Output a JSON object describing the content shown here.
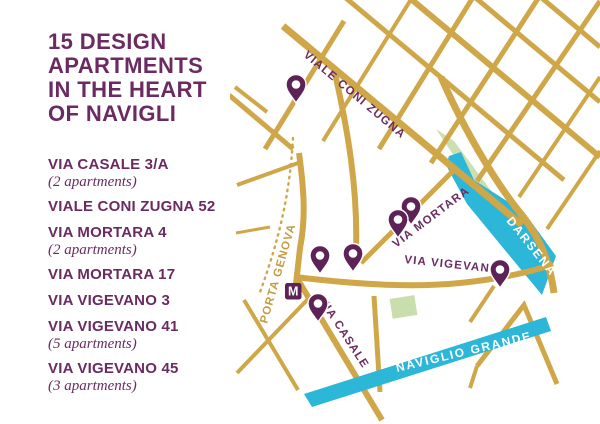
{
  "header": {
    "title_lines": [
      "15 DESIGN",
      "APARTMENTS",
      "IN THE HEART",
      "OF NAVIGLI"
    ]
  },
  "addresses": [
    {
      "name": "VIA CASALE 3/A",
      "note": "(2 apartments)"
    },
    {
      "name": "VIALE CONI ZUGNA 52",
      "note": ""
    },
    {
      "name": "VIA MORTARA 4",
      "note": "(2 apartments)"
    },
    {
      "name": "VIA MORTARA 17",
      "note": ""
    },
    {
      "name": "VIA VIGEVANO 3",
      "note": ""
    },
    {
      "name": "VIA VIGEVANO 41",
      "note": "(5 apartments)"
    },
    {
      "name": "VIA VIGEVANO 45",
      "note": "(3 apartments)"
    }
  ],
  "map": {
    "labels": {
      "coni_zugna": "VIALE CONI ZUGNA",
      "mortara": "VIA MORTARA",
      "vigevano": "VIA VIGEVANO",
      "casale": "VIA CASALE",
      "porta_genova": "PORTA GENOVA",
      "darsena": "DARSENA",
      "naviglio": "NAVIGLIO GRANDE",
      "metro_m": "M"
    },
    "pins": [
      {
        "x": 296,
        "y": 88
      },
      {
        "x": 411,
        "y": 210
      },
      {
        "x": 398,
        "y": 223
      },
      {
        "x": 320,
        "y": 259
      },
      {
        "x": 353,
        "y": 257
      },
      {
        "x": 318,
        "y": 307
      },
      {
        "x": 500,
        "y": 273
      }
    ]
  },
  "colors": {
    "purple_text": "#6b2b62",
    "purple_pin": "#5d2356",
    "street_gold": "#d0a748",
    "water_blue": "#2cb6d8",
    "park_green": "#cbdfb0",
    "label_gold": "#c49c40"
  }
}
